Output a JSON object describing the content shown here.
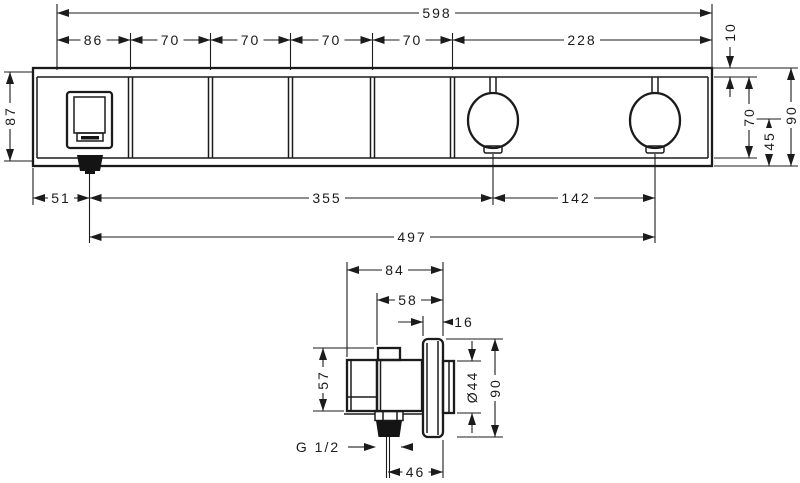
{
  "drawing": {
    "top_view": {
      "overall_width": "598",
      "segments": [
        "86",
        "70",
        "70",
        "70",
        "70",
        "228"
      ],
      "plate_offset": "10",
      "left_height": "87",
      "panel_height": "70",
      "knob_center_to_bottom": "45",
      "right_height": "90",
      "outlet_center_from_left": "51",
      "outlet_to_knob1": "355",
      "knob1_to_knob2": "142",
      "outlet_to_knob2": "497"
    },
    "side_view": {
      "total_depth": "84",
      "body_depth": "58",
      "flange_thickness": "16",
      "body_height": "57",
      "hub_diameter": "Ø44",
      "flange_height": "90",
      "thread_label": "G 1/2",
      "axis_to_wall": "46"
    }
  }
}
